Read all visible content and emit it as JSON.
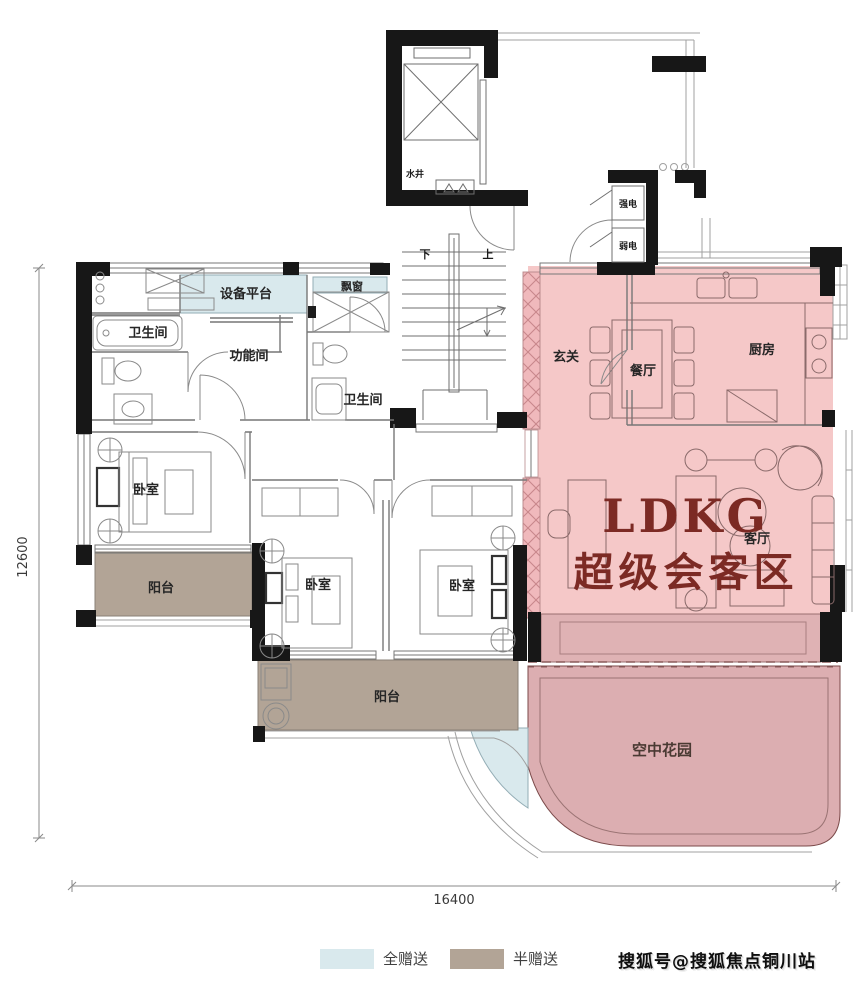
{
  "core": {
    "water_well": "水井",
    "stairs_down": "下",
    "stairs_up": "上",
    "strong_power": "强电",
    "weak_power": "弱电"
  },
  "rooms": {
    "equipment_platform": "设备平台",
    "bay_window": "飘窗",
    "bathroom_a": "卫生间",
    "function_room": "功能间",
    "bathroom_b": "卫生间",
    "entry": "玄关",
    "dining": "餐厅",
    "kitchen": "厨房",
    "living": "客厅",
    "bedroom_a": "卧室",
    "bedroom_b": "卧室",
    "bedroom_c": "卧室",
    "balcony_a": "阳台",
    "balcony_b": "阳台",
    "sky_garden": "空中花园"
  },
  "highlight": {
    "title": "LDKG",
    "subtitle": "超级会客区"
  },
  "dimensions": {
    "left_height": "12600",
    "bottom_width": "16400"
  },
  "legend": {
    "full_gift_label": "全赠送",
    "half_gift_label": "半赠送",
    "full_gift_color": "#d9e9ed",
    "half_gift_color": "#b2a496"
  },
  "watermark": "搜狐号@搜狐焦点铜川站",
  "colors": {
    "highlight_pink": "#f5c8c8",
    "gift_balcony_pink": "#dfb2b4",
    "sky_garden_pink": "#dcaeb1",
    "full_gift_blue": "#d9e9ed",
    "half_gift_tan": "#b2a496",
    "wall_black": "#171717",
    "highlight_text_red": "#7c2a24"
  }
}
